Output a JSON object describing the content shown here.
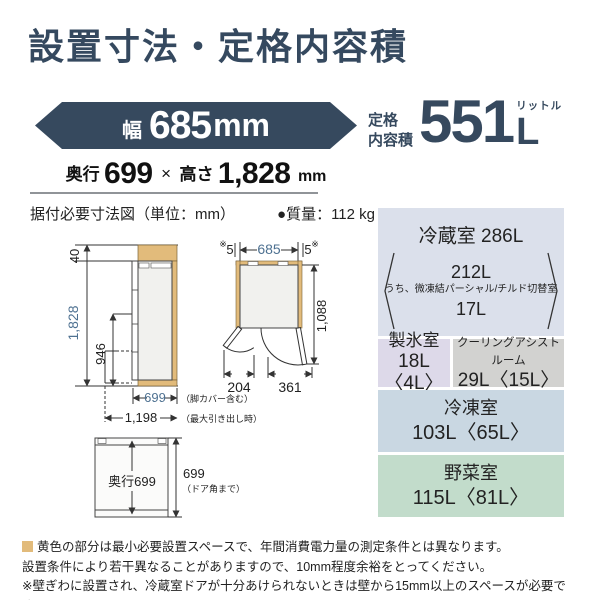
{
  "title": "設置寸法・定格内容積",
  "colors": {
    "accent_slate": "#36495e",
    "dim_blue": "#4e7191",
    "clearance_tan": "#e2bb7b",
    "table_fridge_bg": "#dbe0eb",
    "table_ice_bg": "#ddd9e9",
    "table_cooling_bg": "#d2d2d0",
    "table_freezer_bg": "#c9d7e2",
    "table_vegetable_bg": "#c2dccb"
  },
  "spec": {
    "width": {
      "label": "幅",
      "value": "685",
      "unit": "mm"
    },
    "depth_height": {
      "depth_label": "奥行",
      "depth_value": "699",
      "times": "×",
      "height_label": "高さ",
      "height_value": "1,828",
      "unit": "mm"
    },
    "capacity": {
      "label_line1": "定格",
      "label_line2": "内容積",
      "value": "551",
      "unit": "L",
      "unit_ruby": "リットル"
    }
  },
  "section": {
    "diagram_heading": "据付必要寸法図（単位：mm）",
    "mass": "●質量：112 kg"
  },
  "diagram": {
    "side_view": {
      "top_clearance": "40",
      "height": "1,828",
      "drawer_top_height": "946",
      "depth": "699",
      "depth_note": "（脚カバー含む）",
      "max_depth": "1,198",
      "max_depth_note": "（最大引き出し時）"
    },
    "top_view": {
      "left_mark": "※",
      "left_gap": "5",
      "width": "685",
      "right_gap": "5",
      "right_mark": "※",
      "door_projection": "1,088",
      "left_door_width": "204",
      "right_door_width": "361"
    },
    "depth_view": {
      "inner_label": "奥行699",
      "outer_value": "699",
      "outer_note": "（ドア角まで）"
    }
  },
  "capacity_table": {
    "fridge": {
      "title": "冷蔵室 286L",
      "sub_main": "212L",
      "sub_detail": "うち、微凍結パーシャル/チルド切替室",
      "sub_value": "17L"
    },
    "ice": {
      "title": "製氷室",
      "value": "18L〈4L〉"
    },
    "cooling": {
      "title": "クーリングアシストルーム",
      "value": "29L〈15L〉"
    },
    "freezer": {
      "title": "冷凍室",
      "value": "103L〈65L〉"
    },
    "vegetable": {
      "title": "野菜室",
      "value": "115L〈81L〉"
    }
  },
  "notes": {
    "note1": "黄色の部分は最小必要設置スペースで、年間消費電力量の測定条件とは異なります。",
    "note2": "設置条件により若干異なることがありますので、10mm程度余裕をとってください。",
    "note3": "※壁ぎわに設置され、冷蔵室ドアが十分あけられないときは壁から15mm以上のスペースが必要です。"
  }
}
